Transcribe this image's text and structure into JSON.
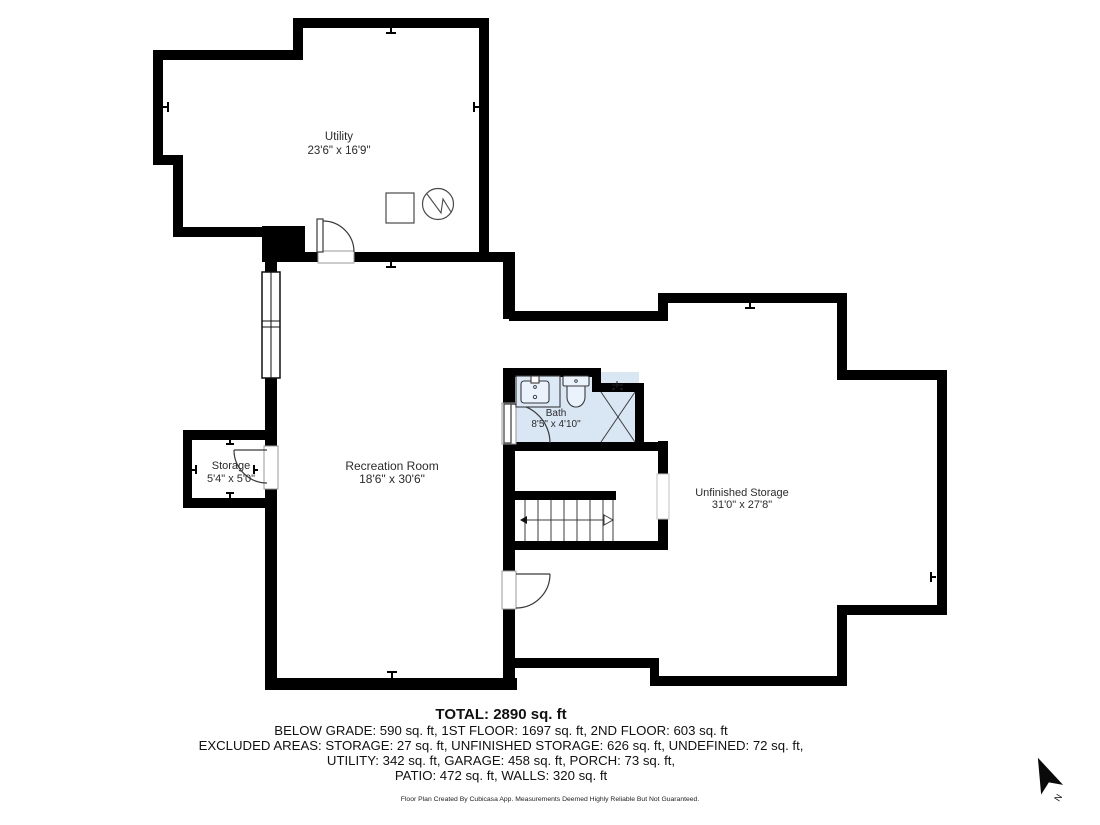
{
  "rooms": {
    "utility": {
      "name": "Utility",
      "dims": "23'6\" x 16'9\""
    },
    "recreation": {
      "name": "Recreation Room",
      "dims": "18'6\" x 30'6\""
    },
    "storage": {
      "name": "Storage",
      "dims": "5'4\" x 5'0\""
    },
    "bath": {
      "name": "Bath",
      "dims": "8'5\" x 4'10\""
    },
    "unfinished": {
      "name": "Unfinished Storage",
      "dims": "31'0\" x 27'8\""
    }
  },
  "summary": {
    "total": "TOTAL: 2890 sq. ft",
    "line1": "BELOW GRADE: 590 sq. ft, 1ST FLOOR: 1697 sq. ft, 2ND FLOOR: 603 sq. ft",
    "line2": "EXCLUDED AREAS: STORAGE: 27 sq. ft, UNFINISHED STORAGE: 626 sq. ft, UNDEFINED: 72 sq. ft,",
    "line3": "UTILITY: 342 sq. ft, GARAGE: 458 sq. ft, PORCH: 73 sq. ft,",
    "line4": "PATIO: 472 sq. ft, WALLS: 320 sq. ft"
  },
  "footer": "Floor Plan Created By Cubicasa App. Measurements Deemed Highly Reliable But Not Guaranteed.",
  "compass": {
    "label": "N"
  },
  "colors": {
    "wall": "#000000",
    "bath_floor": "#d9e7f4",
    "fixture_fill": "#eaf2fb",
    "vanity_fill": "#dbe8f6"
  },
  "icons": {
    "north_arrow": "north-arrow-icon",
    "water_heater": "water-heater-icon",
    "appliance": "appliance-square-icon",
    "shower": "shower-icon",
    "toilet": "toilet-icon",
    "sink": "sink-vanity-icon",
    "stairs": "stairs-icon"
  }
}
